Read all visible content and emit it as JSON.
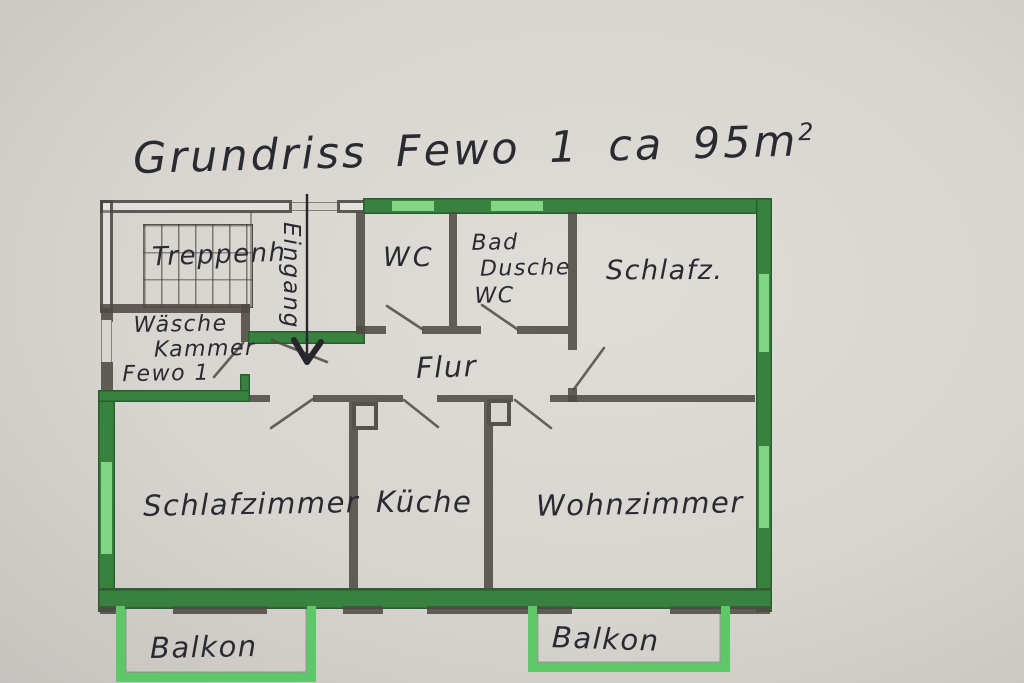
{
  "title": {
    "text": "Grundriss Fewo 1 ca 95m",
    "sup": "2"
  },
  "rooms": {
    "treppenhaus": "Treppenh",
    "eingang": "Eingang",
    "wc": "WC",
    "bad": {
      "line1": "Bad",
      "line2": "Dusche",
      "line3": "WC"
    },
    "schlafz": "Schlafz.",
    "waesche": {
      "line1": "Wäsche",
      "line2": "Kammer",
      "line3": "Fewo 1"
    },
    "flur": "Flur",
    "schlafzimmer": "Schlafzimmer",
    "kueche": "Küche",
    "wohnzimmer": "Wohnzimmer",
    "balkon_left": "Balkon",
    "balkon_right": "Balkon"
  },
  "colors": {
    "paper": "#d8d5d0",
    "paper_light": "#e0ddd8",
    "paper_dark": "#c6c3bf",
    "ink": "#2a2a31",
    "pencil": "#4e4a44",
    "wall_green": "#39813f",
    "wall_green_dark": "#27602c",
    "window_green": "#82d584",
    "balcony_green": "#5ec767"
  }
}
